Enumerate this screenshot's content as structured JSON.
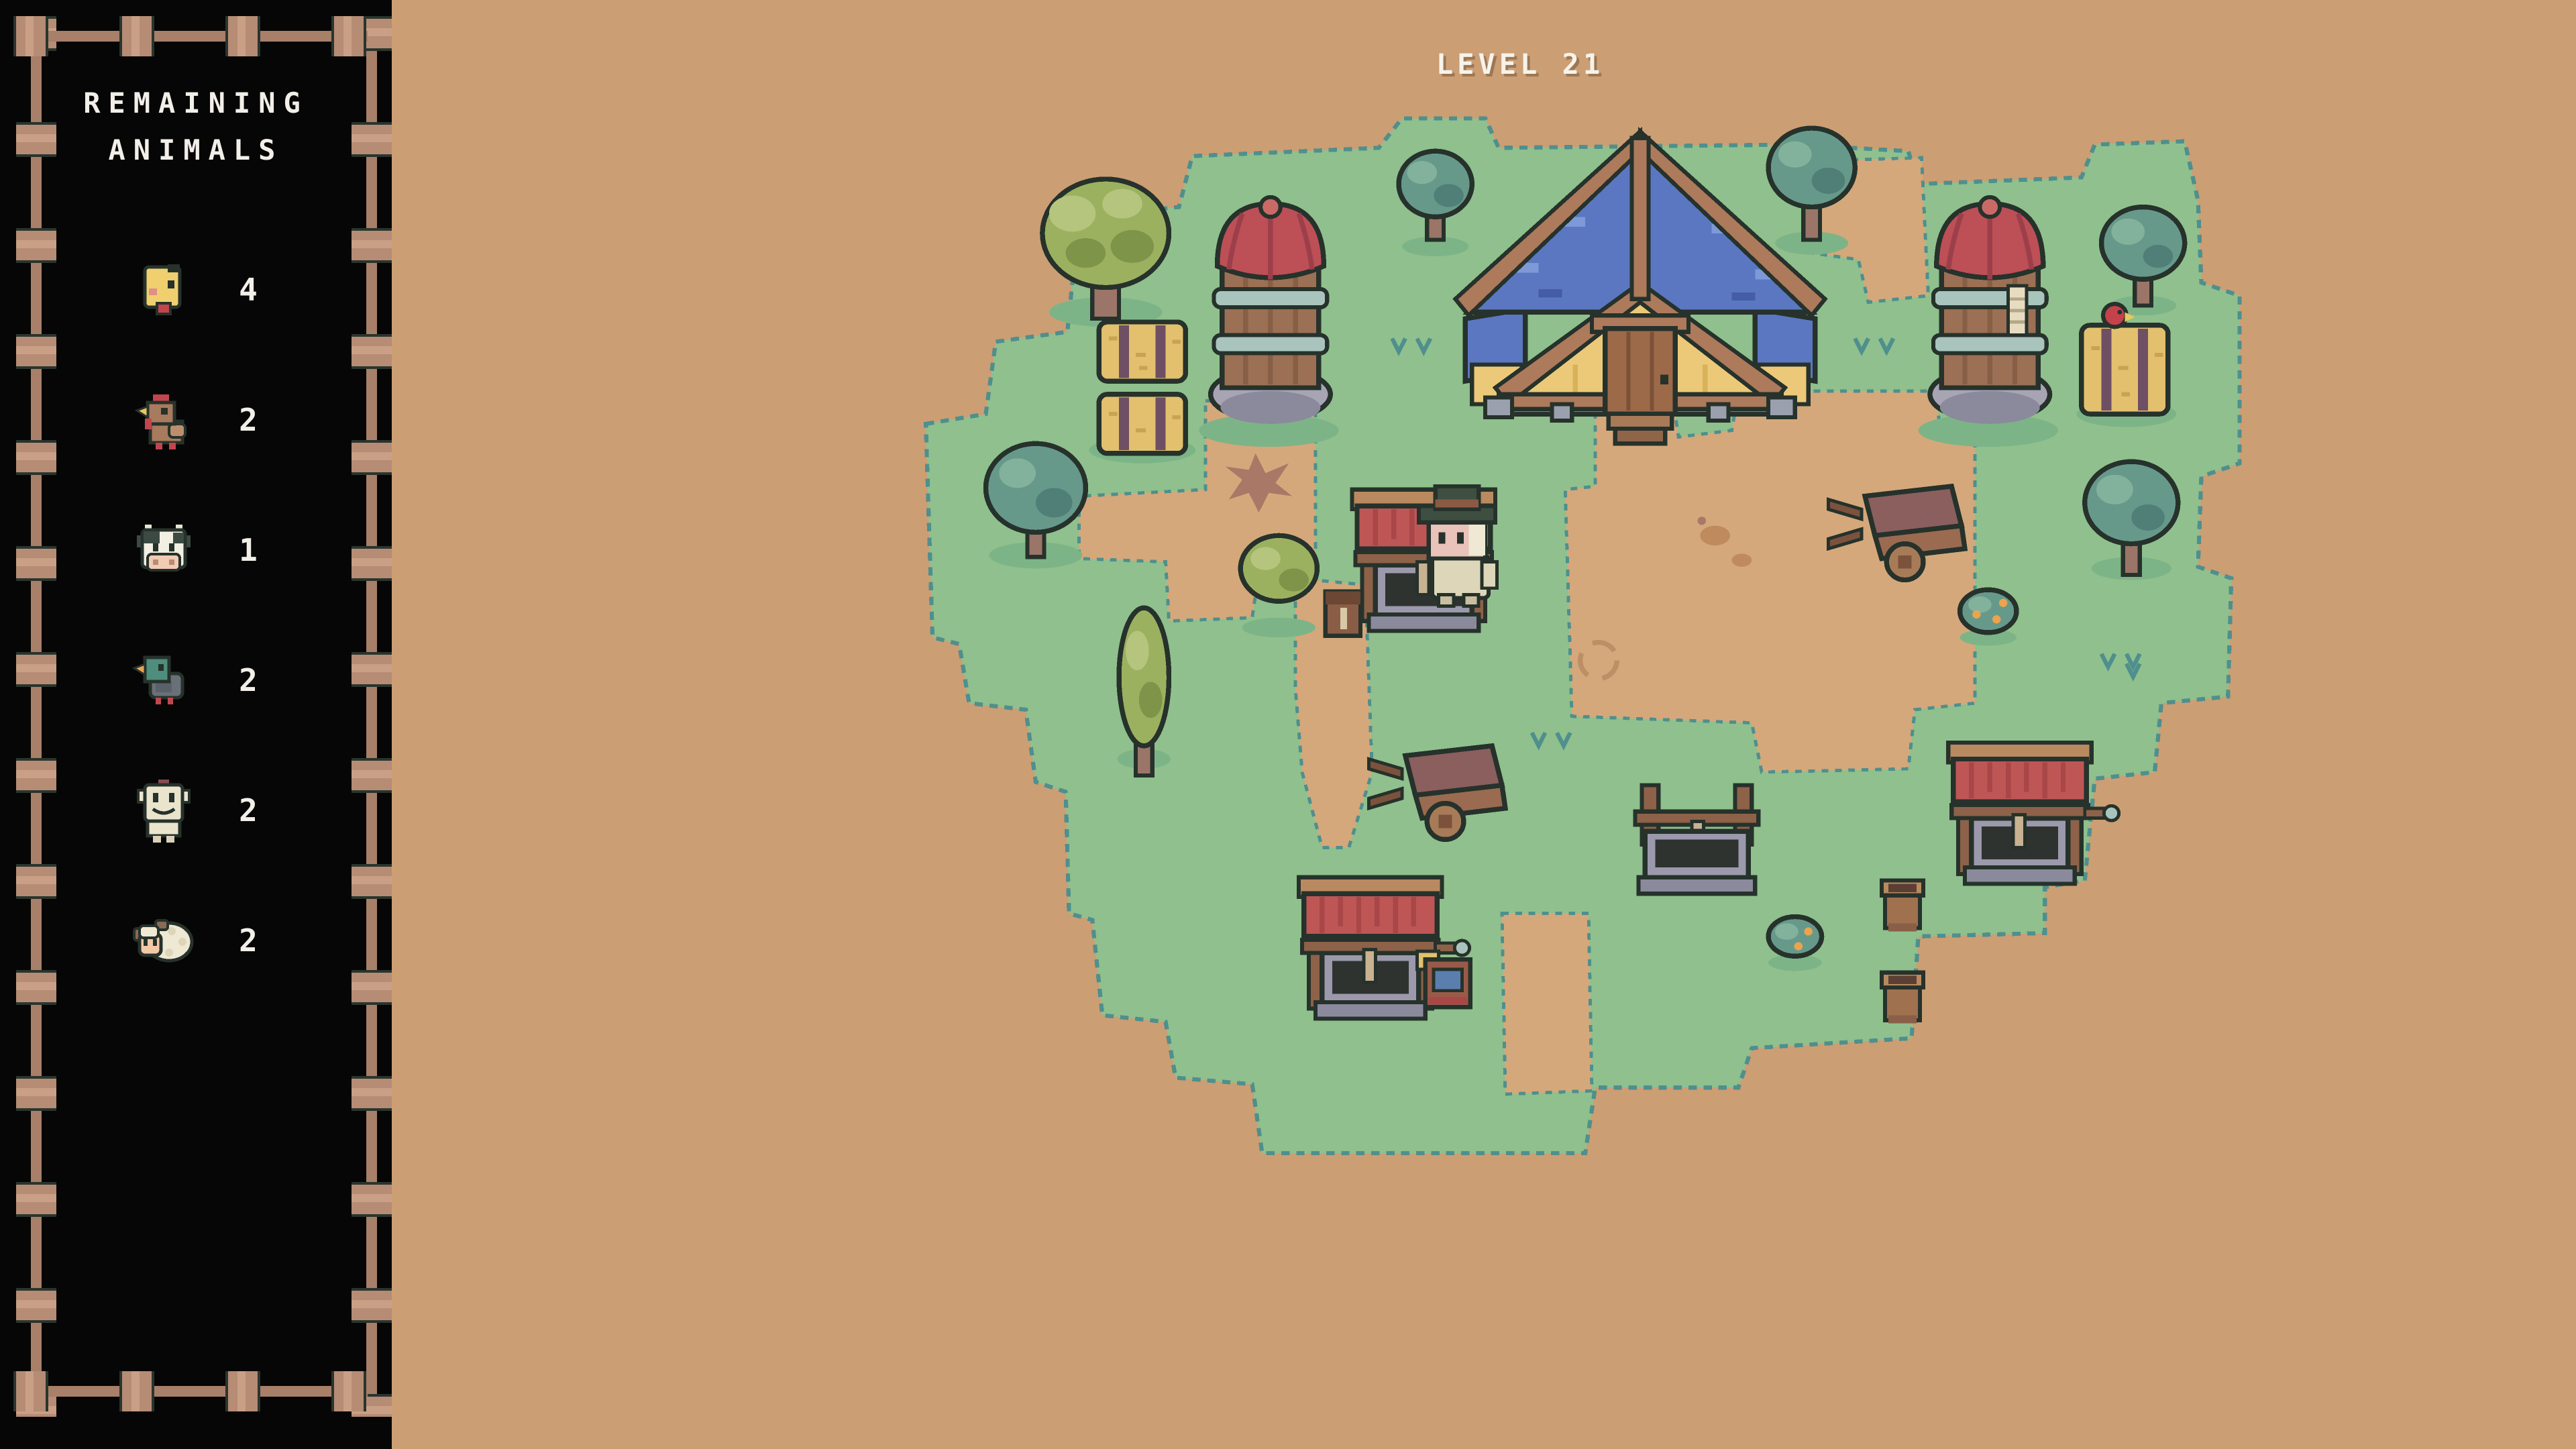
{
  "hud": {
    "level_label": "LEVEL 21"
  },
  "sidebar": {
    "title_line1": "REMAINING",
    "title_line2": "ANIMALS",
    "animals": [
      {
        "name": "chick",
        "icon": "chick-icon",
        "count": "4"
      },
      {
        "name": "chicken",
        "icon": "chicken-icon",
        "count": "2"
      },
      {
        "name": "cow",
        "icon": "cow-icon",
        "count": "1"
      },
      {
        "name": "duck",
        "icon": "duck-icon",
        "count": "2"
      },
      {
        "name": "goat",
        "icon": "goat-icon",
        "count": "2"
      },
      {
        "name": "sheep",
        "icon": "sheep-icon",
        "count": "2"
      }
    ]
  },
  "colors": {
    "background": "#cc9e74",
    "panel": "#060606",
    "fence_wood": "#b68c75",
    "text": "#f2efe9",
    "grass": "#8fc08d",
    "grass_edge": "#4f8f8d",
    "dirt_path": "#d4a87b",
    "barn_roof_blue": "#5b77c2",
    "barn_wall_yellow": "#ecc979",
    "wood_trim": "#ad7a5b",
    "silo_cap_red": "#bd4f56",
    "silo_body": "#9b7054",
    "silo_band": "#a8c4bd",
    "stone_gray": "#9b99ab",
    "well_water": "#2e3330",
    "well_roof_red": "#bf5656",
    "hay_yellow": "#e2c06e",
    "tree_olive": "#9cb15f",
    "tree_teal": "#67998b"
  }
}
